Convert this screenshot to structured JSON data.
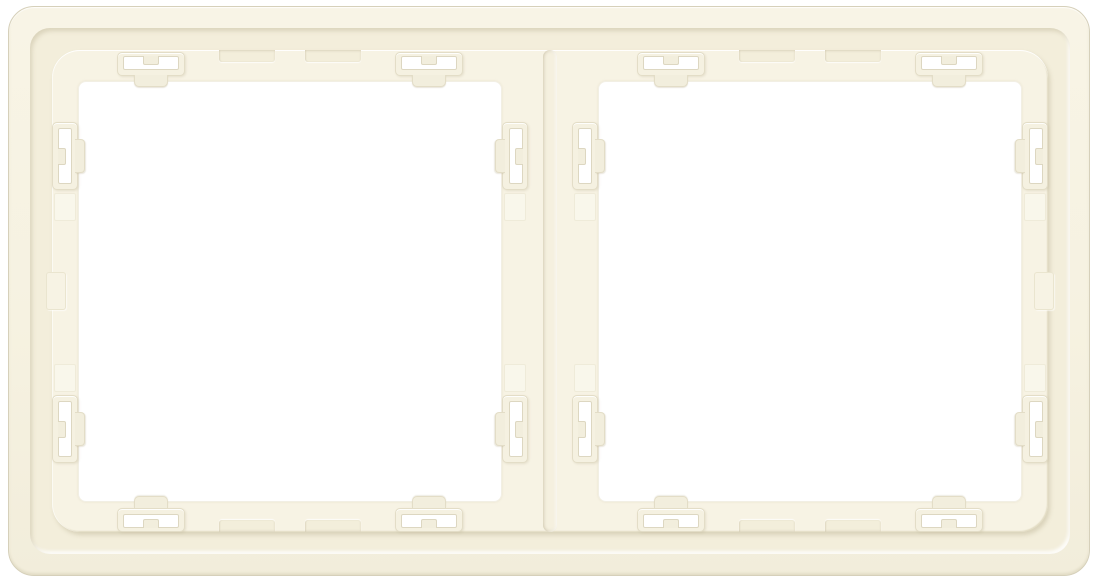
{
  "subject": {
    "description": "Rear view of a two-gang ivory plastic wall-switch surround frame with snap-in latch clips",
    "gang_count": 2,
    "clips_per_opening": 8,
    "finish_name": "ivory-cream"
  },
  "colors": {
    "background": "#ffffff",
    "plate": "#f6f2e1",
    "plate_light": "#f8f4e6",
    "plate_dark": "#f2eddb",
    "plate_border": "#d6d0ba",
    "recess": "#f3eedb",
    "platform": "#f7f3e4",
    "divider": "#f5f0df",
    "opening": "#ffffff",
    "clip_fill": "#f5f1e1",
    "clip_border": "#e3ddc7",
    "slot_border": "#ddd7c1",
    "tab_fill": "#f2eedd"
  }
}
